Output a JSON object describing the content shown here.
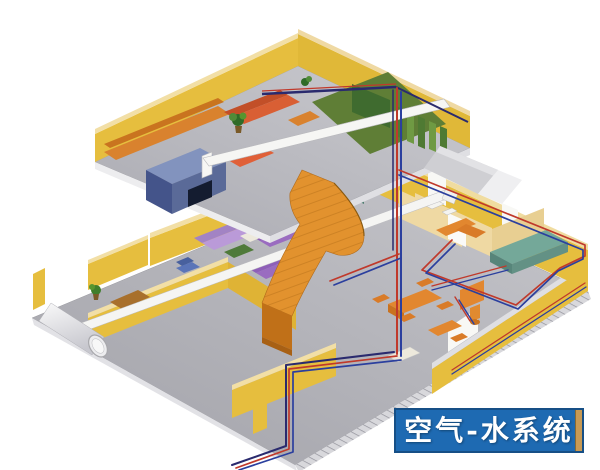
{
  "canvas": {
    "width": 600,
    "height": 470,
    "background": "#FFFFFF"
  },
  "caption": {
    "text": "空气-水系统",
    "background": "#1E6AB2",
    "border": "#164F86",
    "text_color": "#FFFFFF",
    "edge_accent": "#C89A55"
  },
  "illustration": {
    "description": "Isometric cutaway of a two-story building interior showing an air-water HVAC system: white air ducts and red/blue water pipes routed through furnished rooms connected by an orange curved staircase.",
    "colors": {
      "wall_yellow": "#E6BE3E",
      "wall_tan": "#EFD9A3",
      "floor_gray": "#AFAFB5",
      "floor_green": "#5F7E36",
      "stair_orange": "#E2922E",
      "sofa_purple": "#9A6CC0",
      "sofa_lavender": "#BA9AD8",
      "couch_red_orange": "#D95F34",
      "furniture_teal": "#74A899",
      "furniture_orange": "#E2872F",
      "desk_slate_blue": "#5A6A98",
      "duct_white": "#F5F5F3",
      "pipe_hot_red": "#C0392B",
      "pipe_cold_blue": "#2B3F9E",
      "pipe_navy": "#2A2A6E"
    }
  }
}
